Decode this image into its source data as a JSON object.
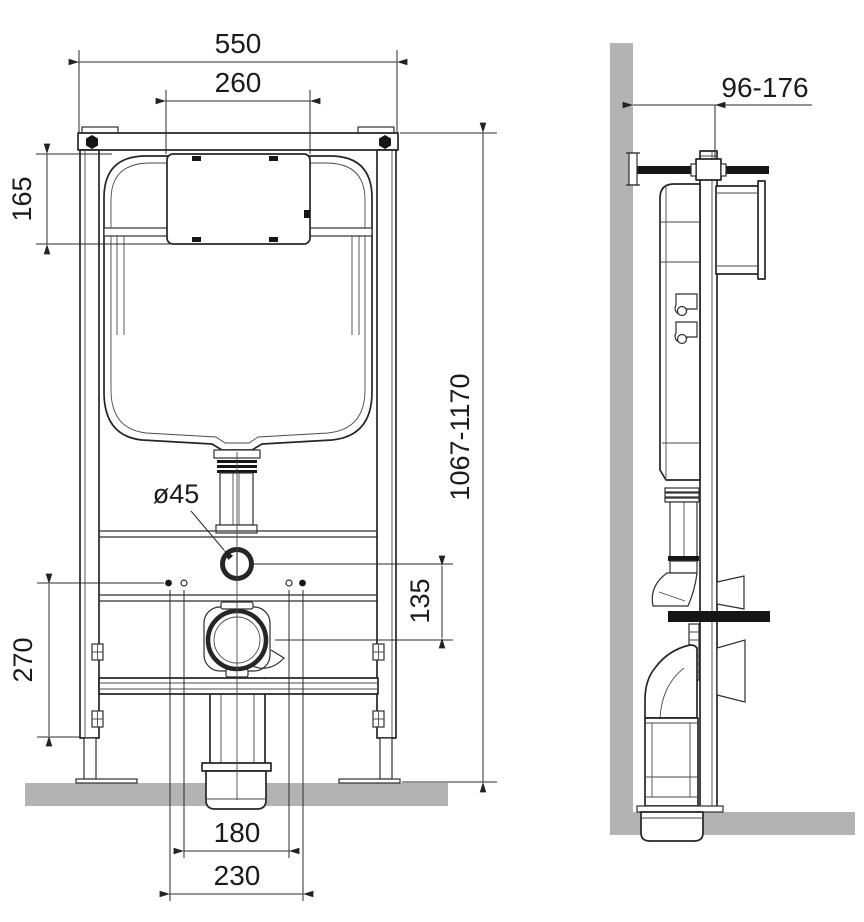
{
  "colors": {
    "line": "#262626",
    "masonry_gray": "#b3b3b3",
    "solid_black": "#161616",
    "background": "#ffffff"
  },
  "front": {
    "dim_overall_width": "550",
    "dim_access_width": "260",
    "dim_access_height": "165",
    "dim_height_range": "1067-1170",
    "dim_supply_hole": "ø45",
    "dim_outlet_offset": "135",
    "dim_lower_span": "270",
    "dim_fixing_inner": "180",
    "dim_fixing_outer": "230"
  },
  "side": {
    "dim_wall_distance": "96-176"
  }
}
